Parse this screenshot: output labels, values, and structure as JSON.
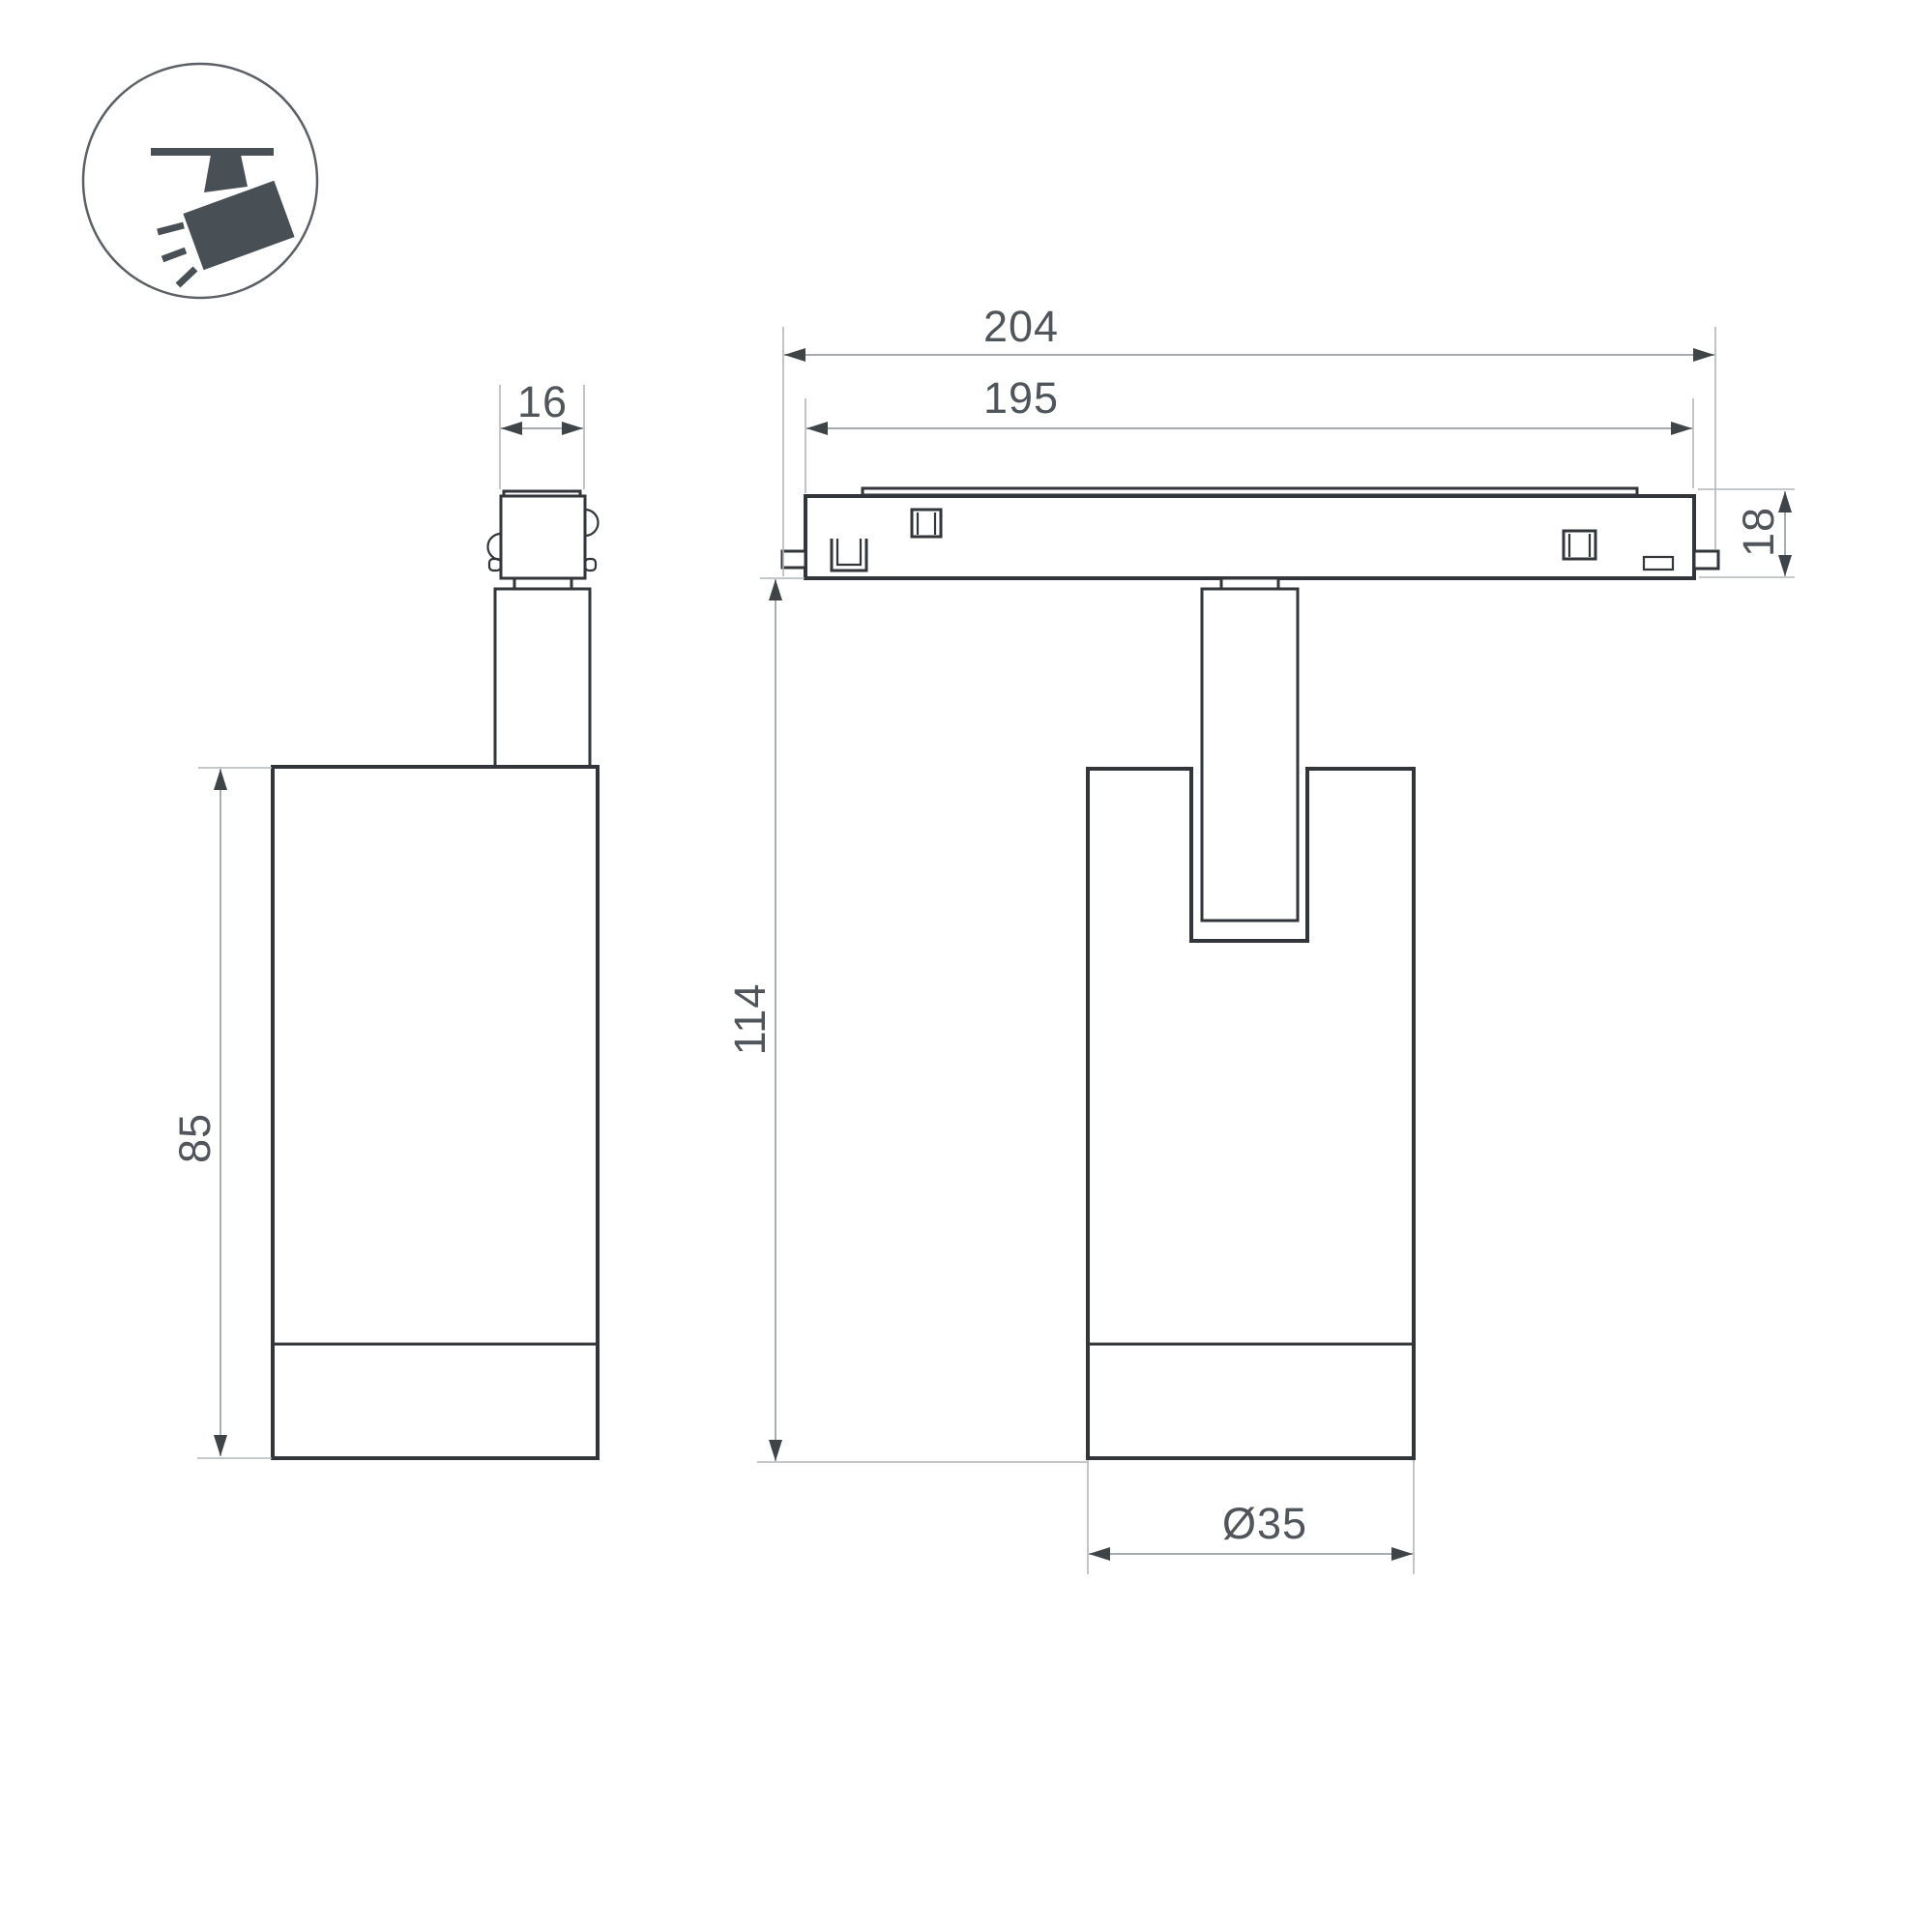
{
  "drawing": {
    "kind": "technical-dimension-drawing",
    "views": [
      "side-view",
      "front-view"
    ]
  },
  "dimensions": {
    "track_length_outer": "204",
    "track_length_inner": "195",
    "track_height": "18",
    "total_height": "114",
    "adapter_width": "16",
    "body_height": "85",
    "body_diameter": "Ø35"
  },
  "colors": {
    "outline": "#32363a",
    "dim_line": "#9aa0a4",
    "ext_line": "#b2b6b9",
    "arrow": "#3f4448",
    "text": "#4f555a",
    "icon": "#485056",
    "background": "#ffffff"
  }
}
